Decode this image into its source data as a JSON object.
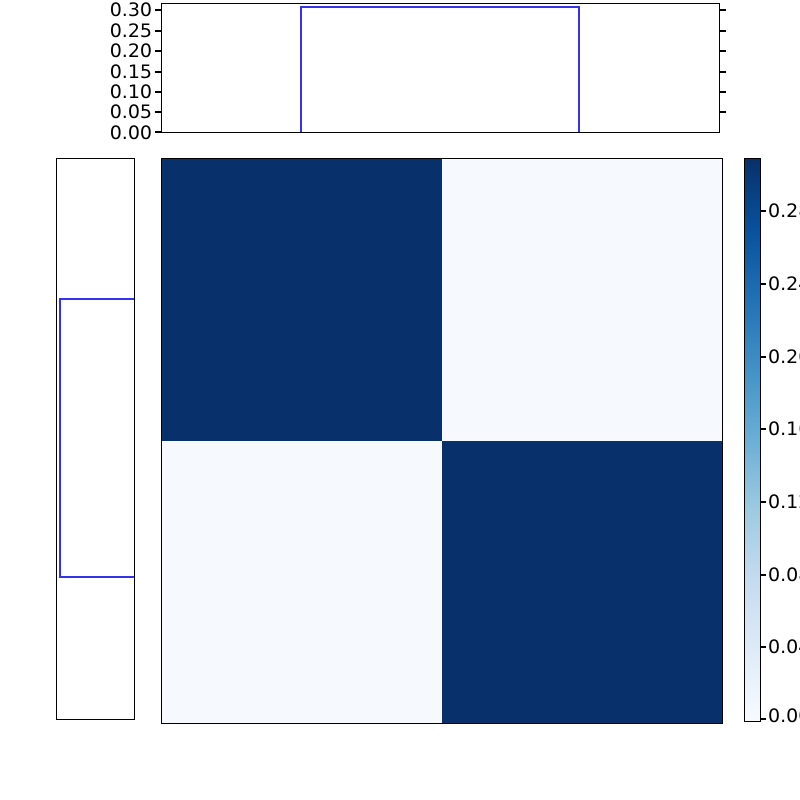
{
  "figure": {
    "description": "Joint probability heatmap (2x2, Blues colormap) with top and left marginal step-function distributions and a vertical colorbar",
    "background": "#ffffff"
  },
  "colors": {
    "axis_border": "#000000",
    "step_line_blue": "#3333ee",
    "heatmap_dark_cell": "#08316c",
    "heatmap_light_cell": "#f6f9fe",
    "colorbar_top": "#08306b",
    "colorbar_bottom": "#f7fbff"
  },
  "top_marginal": {
    "tick_labels": [
      "0.30",
      "0.25",
      "0.20",
      "0.15",
      "0.10",
      "0.05",
      "0.00"
    ]
  },
  "left_marginal": {
    "tick_labels": []
  },
  "colorbar": {
    "tick_labels": [
      "0.28",
      "0.24",
      "0.20",
      "0.16",
      "0.12",
      "0.08",
      "0.04",
      "0.00"
    ]
  },
  "heatmap": {
    "cell_styles": {
      "dark": "background:#08316c",
      "light": "background:#f6f9fe"
    }
  },
  "chart_data": [
    {
      "type": "line",
      "name": "top-marginal-step",
      "line_color": "#3333ee",
      "x_axis_fraction": [
        0.0,
        0.25,
        0.25,
        0.75,
        0.75,
        1.0
      ],
      "y": [
        0.0,
        0.0,
        0.309,
        0.309,
        0.0,
        0.0
      ],
      "ylim": [
        0.0,
        0.317
      ],
      "yticks": [
        0.0,
        0.05,
        0.1,
        0.15,
        0.2,
        0.25,
        0.3
      ],
      "xticks": [],
      "grid": false,
      "legend": "none"
    },
    {
      "type": "line",
      "name": "left-marginal-step",
      "line_color": "#3333ee",
      "y_axis_fraction": [
        0.0,
        0.25,
        0.25,
        0.75,
        0.75,
        1.0
      ],
      "x": [
        0.0,
        0.0,
        0.309,
        0.309,
        0.0,
        0.0
      ],
      "xlim": [
        0.317,
        0.0
      ],
      "x_axis_inverted": true,
      "yticks": [],
      "xticks": [],
      "grid": false,
      "legend": "none"
    },
    {
      "type": "heatmap",
      "name": "joint-distribution-heatmap",
      "matrix": [
        [
          0.309,
          0.005
        ],
        [
          0.005,
          0.309
        ]
      ],
      "rows": 2,
      "cols": 2,
      "colormap": "Blues",
      "vmin": 0.0,
      "vmax": 0.309,
      "colorbar_ticks": [
        0.0,
        0.04,
        0.08,
        0.12,
        0.16,
        0.2,
        0.24,
        0.28
      ],
      "colorbar_position": "right",
      "grid": false
    }
  ]
}
